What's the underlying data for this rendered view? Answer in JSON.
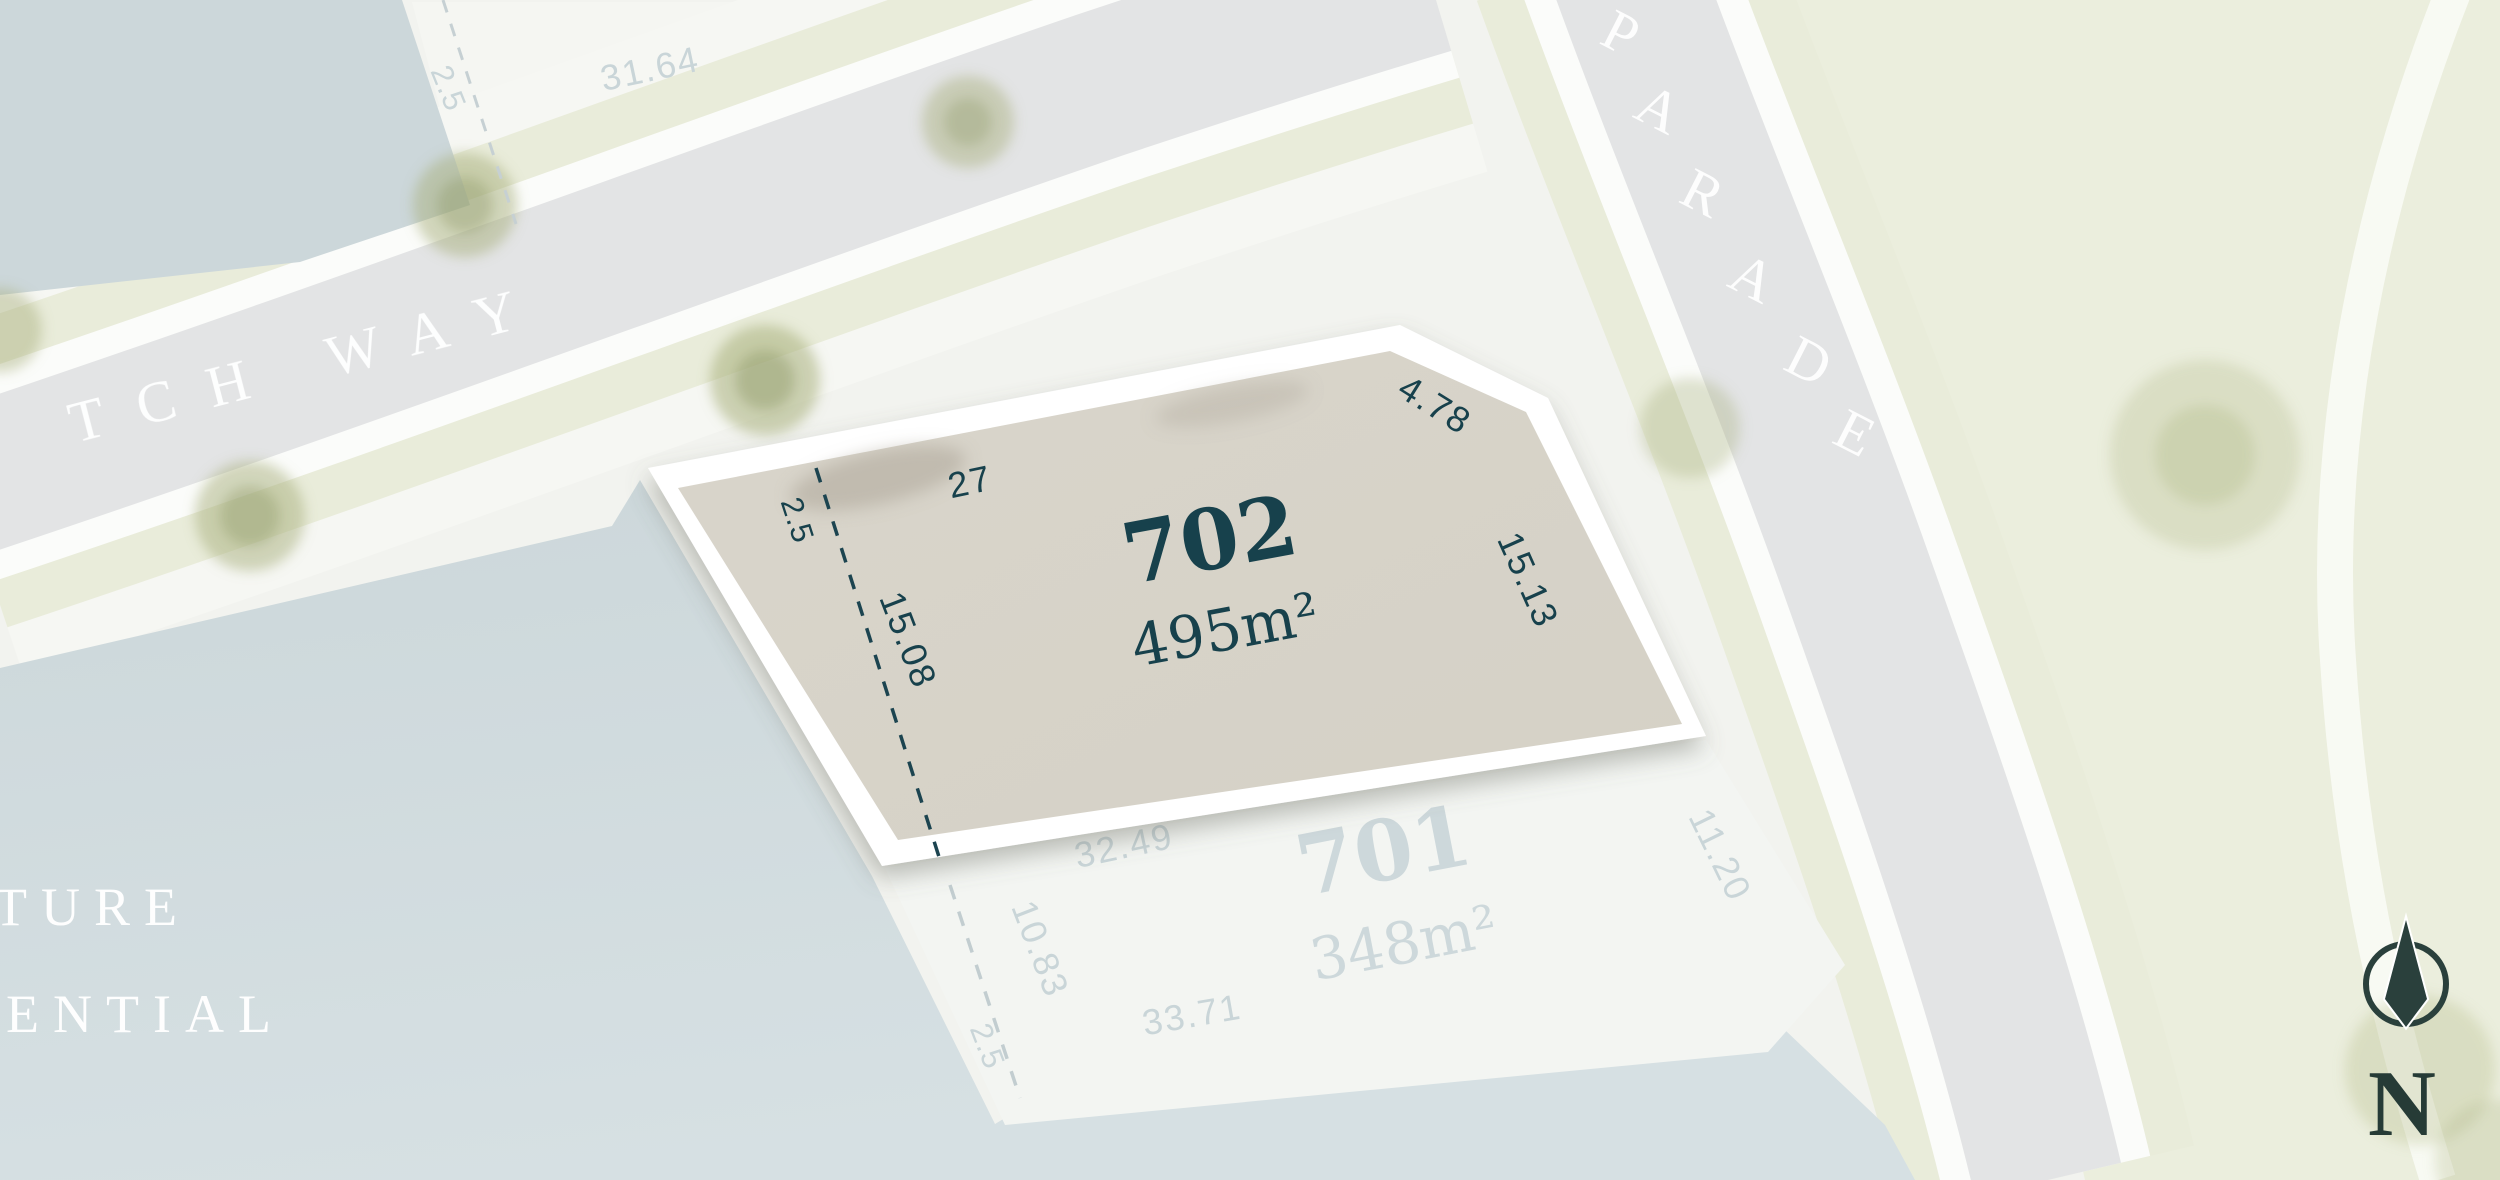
{
  "title": "Estate lot plan",
  "streets": {
    "tch_way": {
      "label": "TCH WAY"
    },
    "parade": {
      "label": "PARADE"
    }
  },
  "future_area": {
    "line1": "TURE",
    "line2": "ENTIAL"
  },
  "lots": {
    "lot702": {
      "number": "702",
      "area": "495m²",
      "dims": {
        "top": "27",
        "chamfer": "4.78",
        "right": "15.13",
        "left": "15.08",
        "easement": "2.5"
      }
    },
    "lot701": {
      "number": "701",
      "area": "348m²",
      "dims": {
        "top": "32.49",
        "left": "10.83",
        "bottom": "33.71",
        "right": "11.20",
        "easement": "2.5"
      }
    },
    "north_lot": {
      "dims": {
        "frontage": "31.64",
        "easement": "2.5"
      }
    }
  },
  "compass": {
    "label": "N"
  },
  "colors": {
    "highlight_fill": "#d8d4c9",
    "highlight_border": "#ffffff",
    "label_teal": "#17414c",
    "compass_teal": "#2a403c",
    "faded_label": "#cdd8db",
    "water": "#ccd7da",
    "road": "#e3e4e5",
    "verge_green": "#e9ecda",
    "right_green": "#ebeedd",
    "background": "#f2f3ef"
  }
}
